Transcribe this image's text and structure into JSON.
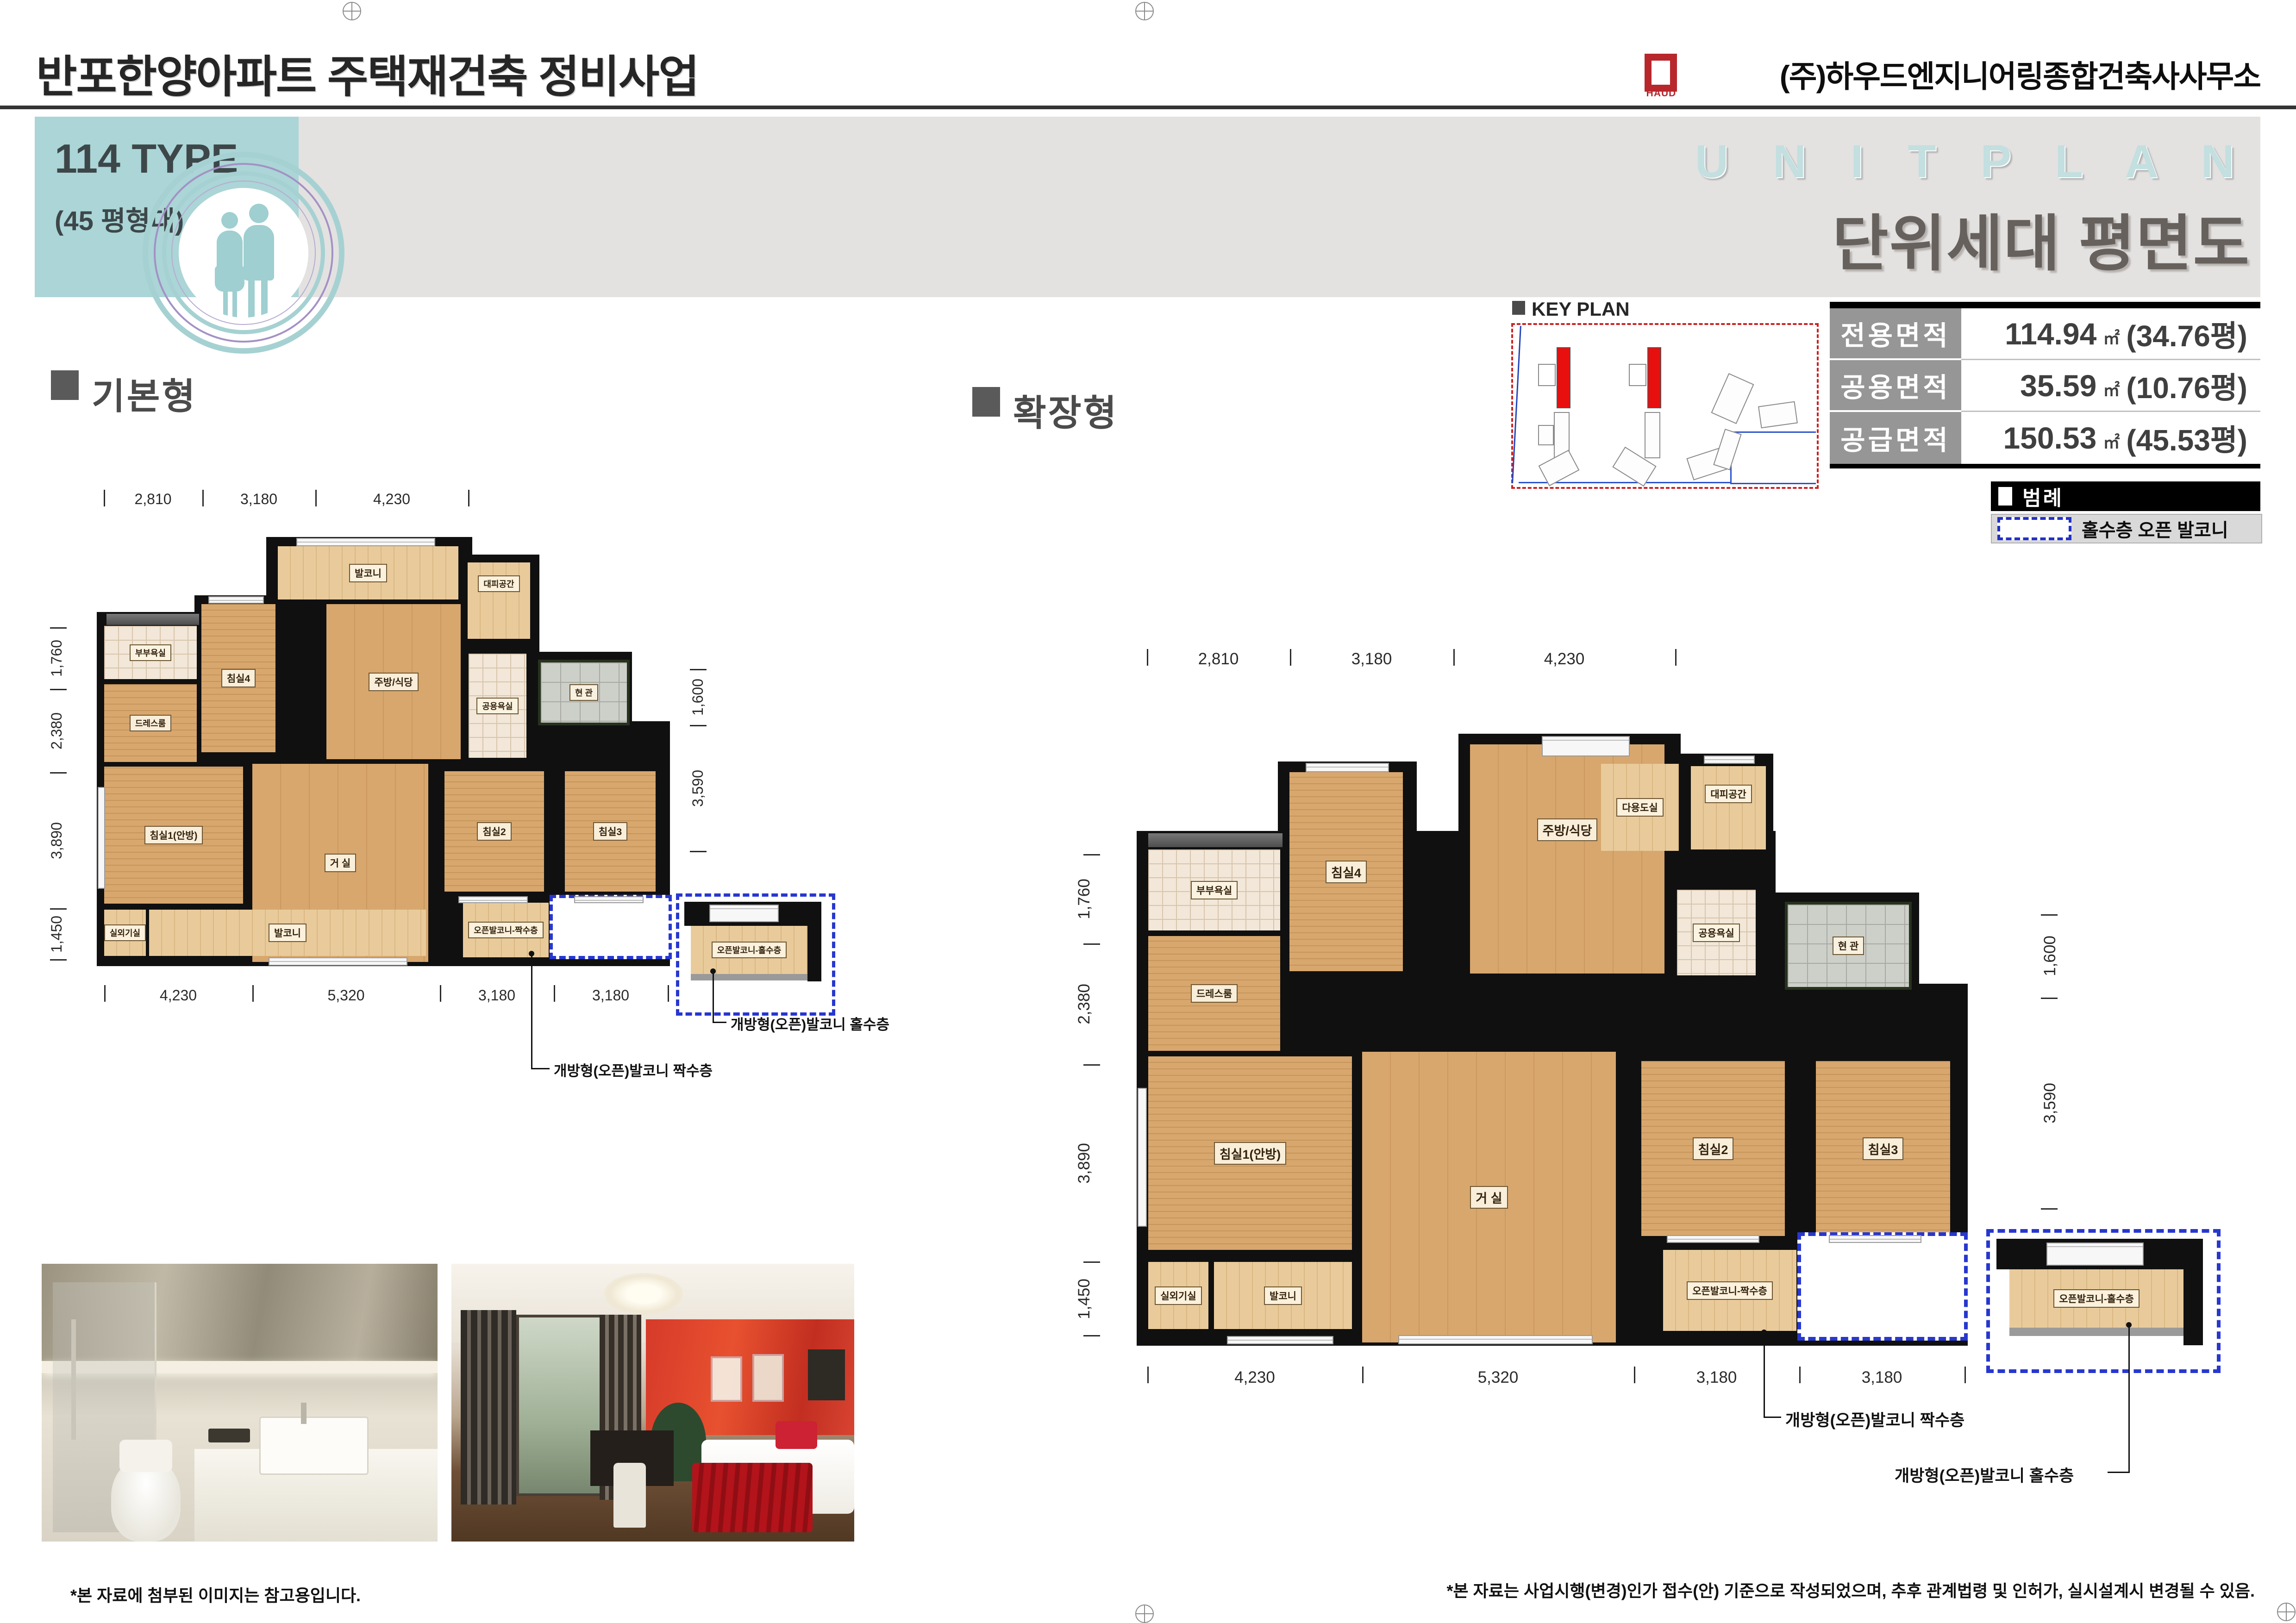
{
  "header": {
    "title": "반포한양아파트 주택재건축 정비사업",
    "company": "(주)하우드엔지니어링종합건축사사무소",
    "logo_text": "HAUD",
    "type_label": "114 TYPE",
    "type_sub": "(45 평형대)",
    "unit_plan_en": "U N I T   P L A N",
    "unit_plan_ko": "단위세대 평면도"
  },
  "keyplan": {
    "label": "KEY PLAN"
  },
  "area_table": {
    "rows": [
      {
        "label": "전용면적",
        "value": "114.94",
        "unit": "㎡",
        "pyeong": "(34.76평)"
      },
      {
        "label": "공용면적",
        "value": "35.59",
        "unit": "㎡",
        "pyeong": "(10.76평)"
      },
      {
        "label": "공급면적",
        "value": "150.53",
        "unit": "㎡",
        "pyeong": "(45.53평)"
      }
    ]
  },
  "legend": {
    "title": "범례",
    "item": "홀수층 오픈 발코니"
  },
  "sections": {
    "basic": "기본형",
    "extended": "확장형"
  },
  "rooms": {
    "balcony": "발코니",
    "shelter": "대피공간",
    "bed4": "침실4",
    "kitchen": "주방/식당",
    "utility": "다용도실",
    "master_bath": "부부욕실",
    "dress": "드레스룸",
    "common_bath": "공용욕실",
    "entrance": "현 관",
    "bed1": "침실1(안방)",
    "living": "거 실",
    "bed2": "침실2",
    "bed3": "침실3",
    "ac": "실외기실",
    "open_even": "오픈발코니-짝수층",
    "open_odd": "오픈발코니-홀수층"
  },
  "callouts": {
    "even": "개방형(오픈)발코니 짝수층",
    "odd": "개방형(오픈)발코니 홀수층"
  },
  "dims": {
    "top": [
      "2,810",
      "3,180",
      "4,230"
    ],
    "bottom": [
      "4,230",
      "5,320",
      "3,180",
      "3,180"
    ],
    "left": [
      "1,760",
      "2,380",
      "3,890",
      "1,450"
    ],
    "right": [
      "1,600",
      "3,590"
    ]
  },
  "footnotes": {
    "left": "*본  자료에 첨부된 이미지는 참고용입니다.",
    "right": "*본  자료는 사업시행(변경)인가 접수(안) 기준으로 작성되었으며, 추후 관계법령 및 인허가, 실시설계시 변경될 수 있음."
  },
  "colors": {
    "accent_teal": "#abd5d6",
    "legend_blue": "#2737cf",
    "logo_red": "#b8272c"
  }
}
